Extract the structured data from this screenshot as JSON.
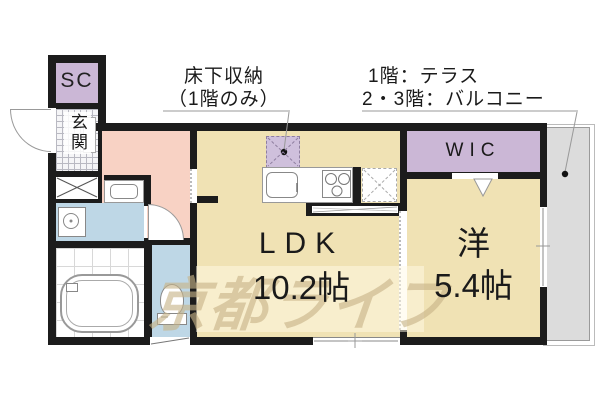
{
  "labels": {
    "underfloor": {
      "line1": "床下収納",
      "line2": "（1階のみ）"
    },
    "floor_note": {
      "line1": "1階：テラス",
      "line2": "2・3階：バルコニー"
    }
  },
  "rooms": {
    "shoe_closet": "SC",
    "entrance": "玄関",
    "walk_in_closet": "WIC",
    "ldk": "LDK",
    "ldk_size": "10.2帖",
    "western": "洋",
    "western_size": "5.4帖"
  },
  "watermark": "京都ライフ",
  "colors": {
    "wall": "#1c1c1c",
    "floor_beige": "#f0e2b4",
    "hallway_pink": "#f8d2c4",
    "closet_purple": "#cbb7d6",
    "wet_area_blue": "#bed7e6",
    "balcony_gray": "#dcdcdc",
    "underfloor_purple": "#cfc0dc",
    "watermark_tan": "#c8b488"
  }
}
